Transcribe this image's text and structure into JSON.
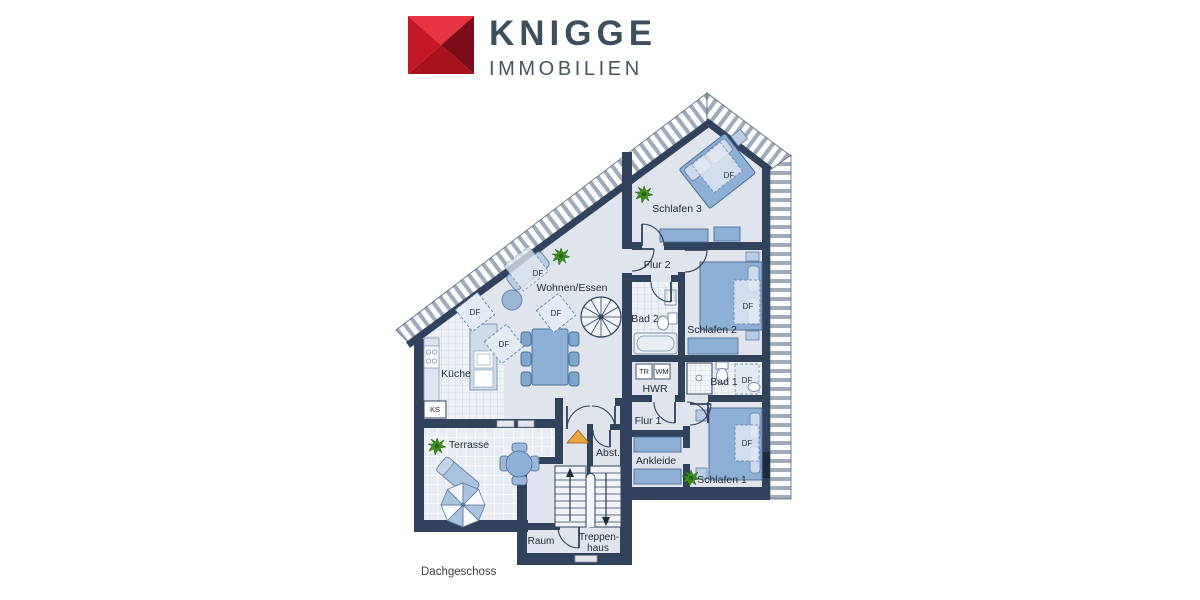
{
  "logo": {
    "brand": "KNIGGE",
    "sub": "IMMOBILIEN"
  },
  "floor_label": "Dachgeschoss",
  "rooms": {
    "wohnen_essen": "Wohnen/Essen",
    "kueche": "Küche",
    "schlafen1": "Schlafen 1",
    "schlafen2": "Schlafen 2",
    "schlafen3": "Schlafen 3",
    "flur1": "Flur 1",
    "flur2": "Flur 2",
    "bad1": "Bad 1",
    "bad2": "Bad 2",
    "hwr": "HWR",
    "ankleide": "Ankleide",
    "abstellraum": "Abst.",
    "terrasse": "Terrasse",
    "raum": "Raum",
    "treppenhaus_line1": "Treppen-",
    "treppenhaus_line2": "haus"
  },
  "labels": {
    "df": "DF",
    "ks": "KS",
    "tr": "TR",
    "wm": "WM"
  },
  "colors": {
    "wall": "#31425c",
    "floor": "#e0e5ed",
    "furniture_blue": "#8fb0d6",
    "brand_red": "#c51726",
    "brand_text": "#3d4f5c",
    "plant_green": "#3f8f1f",
    "entrance_arrow_orange": "#eca63f"
  }
}
